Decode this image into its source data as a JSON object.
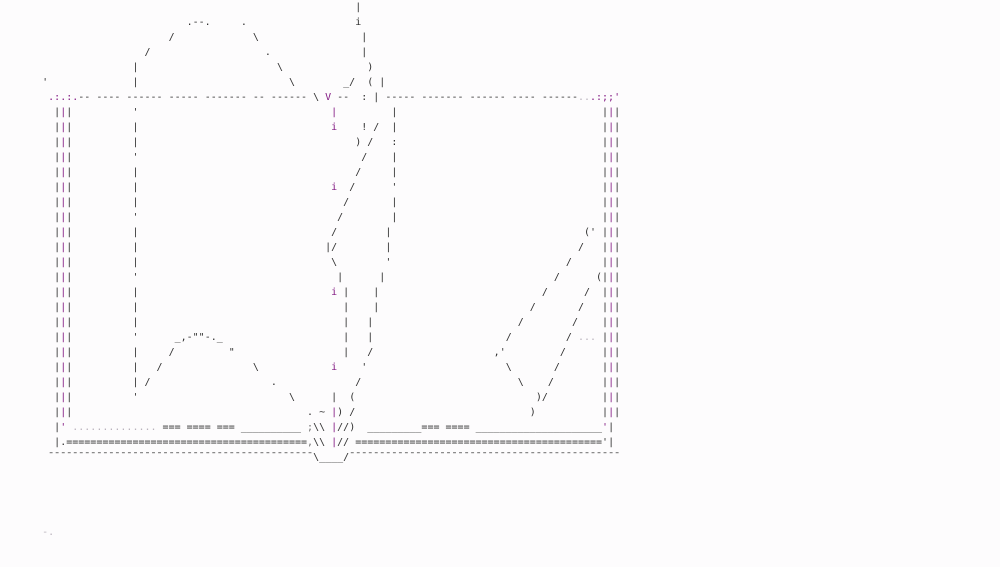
{
  "canvas": {
    "width_px": 1000,
    "height_px": 567,
    "rows_total": 38,
    "background": "#fdfcfd"
  },
  "palette": {
    "d": "#2f2f2f",
    "m": "#831a83",
    "l": "#b9b2bc",
    "g": "#6f6f6f"
  },
  "art": {
    "subject": "ascii-art-open-book",
    "borders": {
      "row_start": 7,
      "row_end": 27,
      "glyph": "|",
      "left_cols": [
        9,
        10,
        11
      ],
      "right_cols": [
        100,
        101,
        102
      ],
      "colors": [
        "d",
        "m",
        "d"
      ]
    },
    "rows": [
      {
        "r": 0,
        "segs": [
          [
            59,
            "|",
            "d"
          ]
        ]
      },
      {
        "r": 1,
        "segs": [
          [
            31,
            ".--.",
            "d"
          ],
          [
            40,
            ".",
            "d"
          ],
          [
            59,
            "i",
            "d"
          ]
        ]
      },
      {
        "r": 2,
        "segs": [
          [
            28,
            "/",
            "d"
          ],
          [
            42,
            "\\",
            "d"
          ],
          [
            60,
            "|",
            "d"
          ]
        ]
      },
      {
        "r": 3,
        "segs": [
          [
            24,
            "/",
            "d"
          ],
          [
            44,
            ".",
            "d"
          ],
          [
            60,
            "|",
            "d"
          ]
        ]
      },
      {
        "r": 4,
        "segs": [
          [
            22,
            "|",
            "d"
          ],
          [
            46,
            "\\",
            "d"
          ],
          [
            61,
            ")",
            "d"
          ]
        ]
      },
      {
        "r": 5,
        "segs": [
          [
            7,
            "'",
            "d"
          ],
          [
            22,
            "|",
            "d"
          ],
          [
            48,
            "\\",
            "d"
          ],
          [
            57,
            "_/",
            "d"
          ],
          [
            61,
            "(",
            "d"
          ],
          [
            63,
            "|",
            "d"
          ]
        ]
      },
      {
        "r": 6,
        "segs": [
          [
            8,
            ".:.:.",
            "m"
          ],
          [
            13,
            "-- ---- ------ ----- ------- -- ------",
            "d"
          ],
          [
            52,
            "\\",
            "d"
          ],
          [
            54,
            "V",
            "m"
          ],
          [
            56,
            "--",
            "d"
          ],
          [
            60,
            ":",
            "d"
          ],
          [
            62,
            "|",
            "d"
          ],
          [
            64,
            "----- ------- ------ ---- ------",
            "d"
          ],
          [
            96,
            "..",
            "l"
          ],
          [
            98,
            ".:;;'",
            "m"
          ]
        ]
      },
      {
        "r": 7,
        "segs": [
          [
            22,
            "'",
            "d"
          ],
          [
            55,
            "|",
            "m"
          ],
          [
            65,
            "|",
            "d"
          ]
        ]
      },
      {
        "r": 8,
        "segs": [
          [
            22,
            "|",
            "d"
          ],
          [
            55,
            "i",
            "m"
          ],
          [
            60,
            "!",
            "d"
          ],
          [
            62,
            "/",
            "d"
          ],
          [
            65,
            "|",
            "d"
          ]
        ]
      },
      {
        "r": 9,
        "segs": [
          [
            22,
            "|",
            "d"
          ],
          [
            59,
            ")",
            "d"
          ],
          [
            61,
            "/",
            "d"
          ],
          [
            65,
            ":",
            "d"
          ]
        ]
      },
      {
        "r": 10,
        "segs": [
          [
            22,
            "'",
            "d"
          ],
          [
            60,
            "/",
            "d"
          ],
          [
            65,
            "|",
            "d"
          ]
        ]
      },
      {
        "r": 11,
        "segs": [
          [
            22,
            "|",
            "d"
          ],
          [
            59,
            "/",
            "d"
          ],
          [
            65,
            "|",
            "d"
          ]
        ]
      },
      {
        "r": 12,
        "segs": [
          [
            22,
            "|",
            "d"
          ],
          [
            55,
            "i",
            "m"
          ],
          [
            58,
            "/",
            "d"
          ],
          [
            65,
            "'",
            "d"
          ]
        ]
      },
      {
        "r": 13,
        "segs": [
          [
            22,
            "|",
            "d"
          ],
          [
            57,
            "/",
            "d"
          ],
          [
            65,
            "|",
            "d"
          ]
        ]
      },
      {
        "r": 14,
        "segs": [
          [
            22,
            "'",
            "d"
          ],
          [
            56,
            "/",
            "d"
          ],
          [
            65,
            "|",
            "d"
          ]
        ]
      },
      {
        "r": 15,
        "segs": [
          [
            22,
            "|",
            "d"
          ],
          [
            55,
            "/",
            "d"
          ],
          [
            64,
            "|",
            "d"
          ],
          [
            97,
            "('",
            "d"
          ]
        ]
      },
      {
        "r": 16,
        "segs": [
          [
            22,
            "|",
            "d"
          ],
          [
            54,
            "|/",
            "d"
          ],
          [
            64,
            "|",
            "d"
          ],
          [
            96,
            "/",
            "d"
          ]
        ]
      },
      {
        "r": 17,
        "segs": [
          [
            22,
            "|",
            "d"
          ],
          [
            55,
            "\\",
            "d"
          ],
          [
            64,
            "'",
            "d"
          ],
          [
            94,
            "/",
            "d"
          ]
        ]
      },
      {
        "r": 18,
        "segs": [
          [
            22,
            "'",
            "d"
          ],
          [
            56,
            "|",
            "d"
          ],
          [
            63,
            "|",
            "d"
          ],
          [
            92,
            "/",
            "d"
          ],
          [
            99,
            "(",
            "d"
          ]
        ]
      },
      {
        "r": 19,
        "segs": [
          [
            22,
            "|",
            "d"
          ],
          [
            55,
            "i",
            "m"
          ],
          [
            57,
            "|",
            "d"
          ],
          [
            62,
            "|",
            "d"
          ],
          [
            90,
            "/",
            "d"
          ],
          [
            97,
            "/",
            "d"
          ]
        ]
      },
      {
        "r": 20,
        "segs": [
          [
            22,
            "|",
            "d"
          ],
          [
            57,
            "|",
            "d"
          ],
          [
            62,
            "|",
            "d"
          ],
          [
            88,
            "/",
            "d"
          ],
          [
            96,
            "/",
            "d"
          ]
        ]
      },
      {
        "r": 21,
        "segs": [
          [
            22,
            "|",
            "d"
          ],
          [
            57,
            "|",
            "d"
          ],
          [
            61,
            "|",
            "d"
          ],
          [
            86,
            "/",
            "d"
          ],
          [
            95,
            "/",
            "d"
          ]
        ]
      },
      {
        "r": 22,
        "segs": [
          [
            22,
            "'",
            "d"
          ],
          [
            29,
            "_,-\"\"-._",
            "d"
          ],
          [
            57,
            "|",
            "d"
          ],
          [
            61,
            "|",
            "d"
          ],
          [
            84,
            "/",
            "d"
          ],
          [
            94,
            "/",
            "d"
          ],
          [
            96,
            "...",
            "l"
          ]
        ]
      },
      {
        "r": 23,
        "segs": [
          [
            22,
            "|",
            "d"
          ],
          [
            28,
            "/",
            "d"
          ],
          [
            38,
            "\"",
            "d"
          ],
          [
            57,
            "|",
            "d"
          ],
          [
            61,
            "/",
            "d"
          ],
          [
            82,
            ",'",
            "d"
          ],
          [
            93,
            "/",
            "d"
          ]
        ]
      },
      {
        "r": 24,
        "segs": [
          [
            22,
            "|",
            "d"
          ],
          [
            26,
            "/",
            "d"
          ],
          [
            42,
            "\\",
            "d"
          ],
          [
            55,
            "i",
            "m"
          ],
          [
            60,
            "'",
            "d"
          ],
          [
            84,
            "\\",
            "d"
          ],
          [
            92,
            "/",
            "d"
          ]
        ]
      },
      {
        "r": 25,
        "segs": [
          [
            22,
            "|",
            "d"
          ],
          [
            24,
            "/",
            "d"
          ],
          [
            45,
            ".",
            "d"
          ],
          [
            59,
            "/",
            "d"
          ],
          [
            86,
            "\\",
            "d"
          ],
          [
            91,
            "/",
            "d"
          ]
        ]
      },
      {
        "r": 26,
        "segs": [
          [
            22,
            "'",
            "d"
          ],
          [
            48,
            "\\",
            "d"
          ],
          [
            55,
            "|",
            "d"
          ],
          [
            58,
            "(",
            "d"
          ],
          [
            89,
            ")/",
            "d"
          ]
        ]
      },
      {
        "r": 27,
        "segs": [
          [
            51,
            ".",
            "d"
          ],
          [
            53,
            "~",
            "d"
          ],
          [
            55,
            "|",
            "m"
          ],
          [
            56,
            ")",
            "d"
          ],
          [
            58,
            "/",
            "d"
          ],
          [
            88,
            ")",
            "d"
          ]
        ]
      },
      {
        "r": 28,
        "segs": [
          [
            9,
            "|",
            "d"
          ],
          [
            10,
            "'",
            "m"
          ],
          [
            12,
            "..............",
            "l"
          ],
          [
            27,
            "=== ==== ===",
            "d"
          ],
          [
            40,
            "__________",
            "d"
          ],
          [
            51,
            ";",
            "g"
          ],
          [
            52,
            "\\\\",
            "d"
          ],
          [
            55,
            "|",
            "m"
          ],
          [
            56,
            "//",
            "d"
          ],
          [
            58,
            ")",
            "d"
          ],
          [
            61,
            "_________",
            "d"
          ],
          [
            70,
            "=== ====",
            "d"
          ],
          [
            79,
            "_____________________",
            "d"
          ],
          [
            100,
            "'",
            "m"
          ],
          [
            101,
            "|",
            "d"
          ]
        ]
      },
      {
        "r": 29,
        "segs": [
          [
            9,
            "|",
            "d"
          ],
          [
            10,
            ".",
            "d"
          ],
          [
            11,
            "========================================",
            "d"
          ],
          [
            51,
            ",",
            "g"
          ],
          [
            52,
            "\\",
            "d"
          ],
          [
            53,
            "\\",
            "d"
          ],
          [
            55,
            "|",
            "m"
          ],
          [
            56,
            "//",
            "d"
          ],
          [
            59,
            "=========================================",
            "d"
          ],
          [
            100,
            "'",
            "d"
          ],
          [
            101,
            "|",
            "d"
          ]
        ]
      },
      {
        "r": 30,
        "segs": [
          [
            8,
            "¯¯¯¯¯¯¯¯¯¯¯¯¯¯¯¯¯¯¯¯¯¯¯¯¯¯¯¯¯¯¯¯¯¯¯¯¯¯¯¯¯¯¯¯",
            "d"
          ],
          [
            52,
            "\\",
            "d"
          ],
          [
            53,
            "____",
            "d"
          ],
          [
            57,
            "/",
            "d"
          ],
          [
            58,
            "¯¯¯¯¯¯¯¯¯¯¯¯¯¯¯¯¯¯¯¯¯¯¯¯¯¯¯¯¯¯¯¯¯¯¯¯¯¯¯¯¯¯¯¯¯",
            "d"
          ]
        ]
      },
      {
        "r": 35,
        "segs": [
          [
            7,
            "-.",
            "l"
          ]
        ]
      }
    ]
  }
}
